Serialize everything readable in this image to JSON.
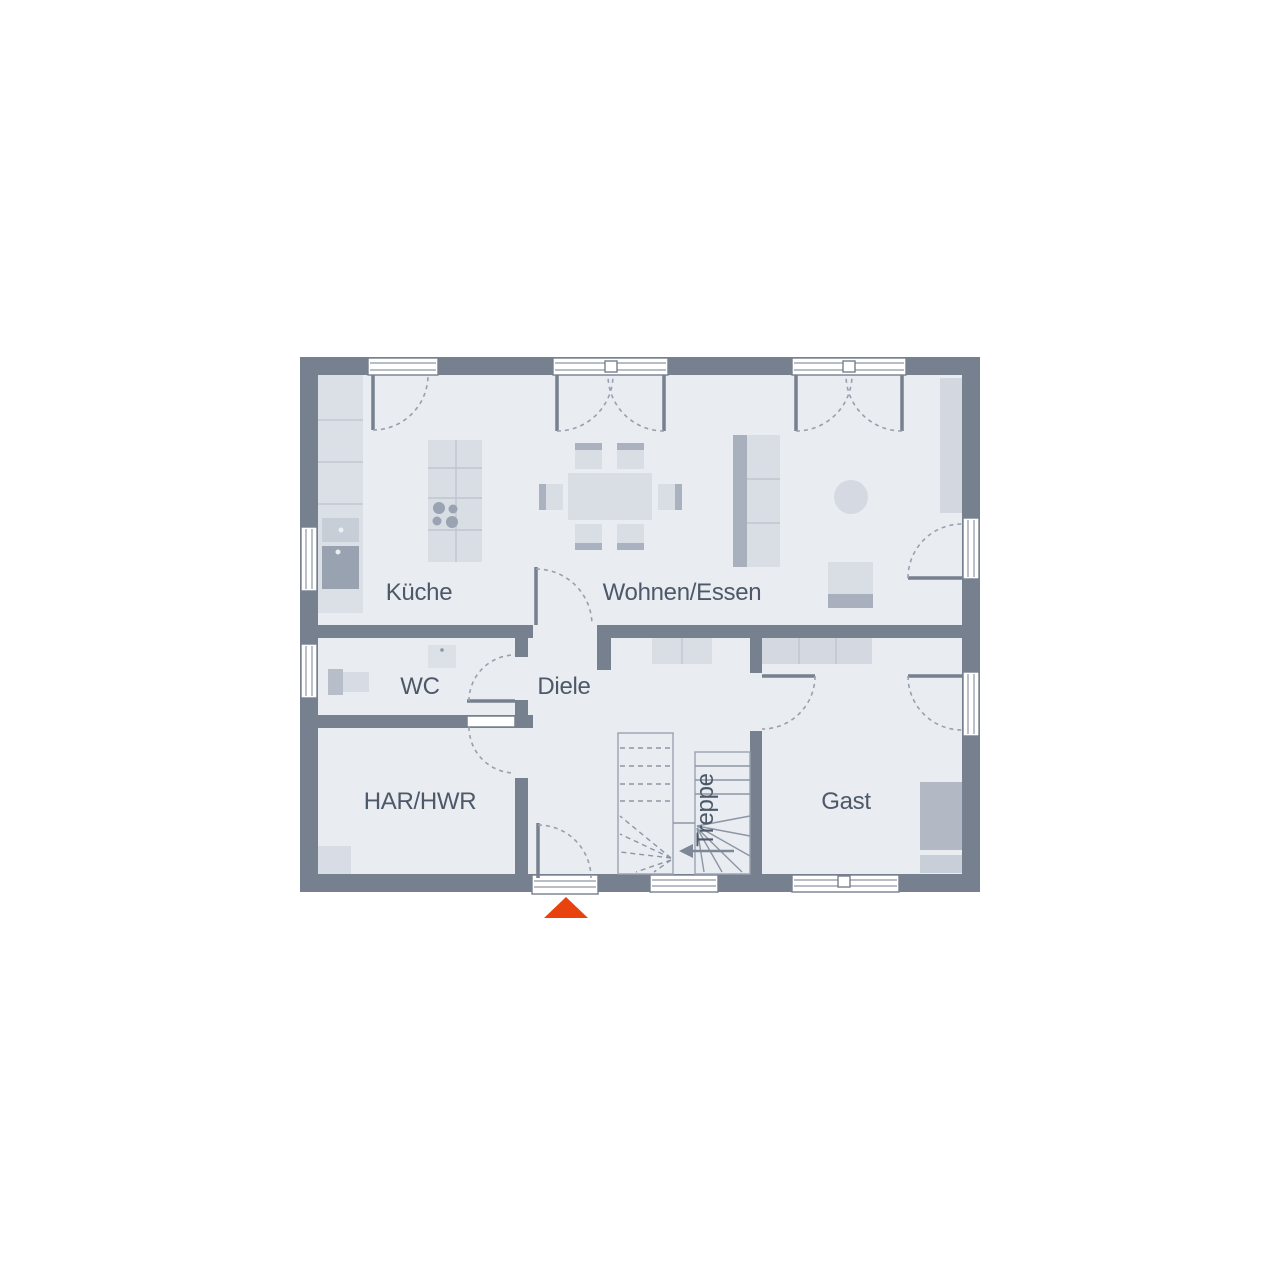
{
  "plan": {
    "type": "ground-floor-plan",
    "rooms": {
      "kueche": "Küche",
      "wohnen_essen": "Wohnen/Essen",
      "wc": "WC",
      "diele": "Diele",
      "har_hwr": "HAR/HWR",
      "treppe": "Treppe",
      "gast": "Gast"
    },
    "colors": {
      "background": "#ffffff",
      "wall": "#76808e",
      "floor": "#e9ecf1",
      "furniture_light": "#d9dde4",
      "furniture_medium": "#c7ced8",
      "furniture_dark": "#a6aebb",
      "drawing_line": "#8d96a4",
      "label_text": "#4d5968",
      "entrance_marker": "#e8430f"
    },
    "markers": {
      "entrance_triangle": "triangle-up"
    }
  }
}
